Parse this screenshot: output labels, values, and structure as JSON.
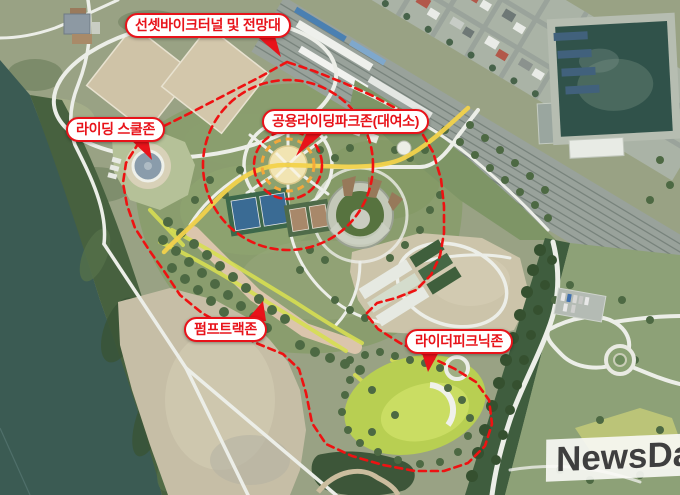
{
  "annotations": {
    "sunset_tunnel": "선셋바이크터널 및 전망대",
    "riding_school": "라이딩 스쿨존",
    "public_riding_park": "공용라이딩파크존(대여소)",
    "pump_track": "펌프트랙존",
    "rider_picnic": "라이더피크닉존"
  },
  "watermark": {
    "text": "NewsDa"
  },
  "colors": {
    "label_red": "#e8131a",
    "boundary_red": "#ee1212",
    "orange_ring": "#f2a83c",
    "route_yellow": "#f2d24b",
    "lime_path": "#d6de52",
    "water_teal": "#3b5b53",
    "pond_green": "#30524a",
    "picnic_green": "#b8cf52",
    "watermark_text": "#3f3f3f"
  }
}
